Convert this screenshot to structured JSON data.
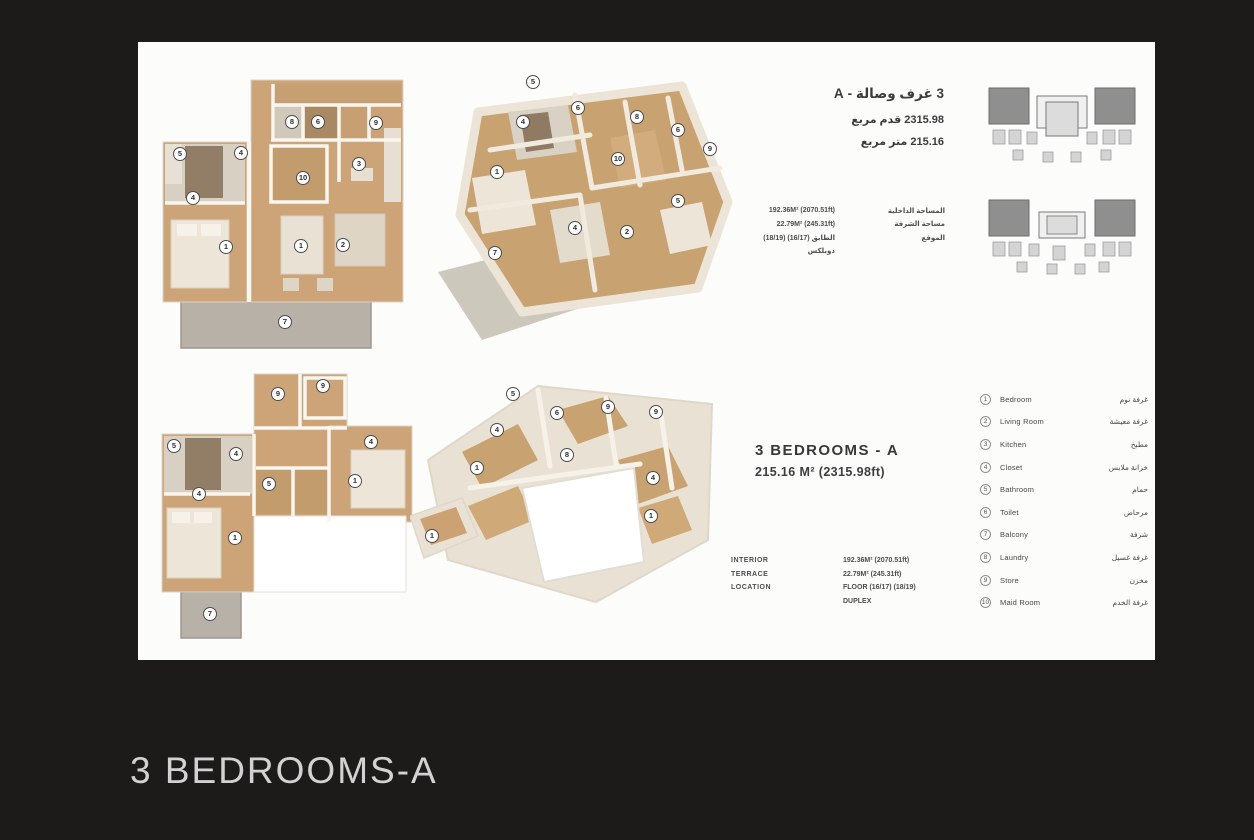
{
  "page": {
    "heading": "3 BEDROOMS-A"
  },
  "panel": {
    "arabic_title": {
      "line1": "3 غرف وصالة - A",
      "line2": "2315.98 قدم مربع",
      "line3": "215.16 متر مربع"
    },
    "unit_title": {
      "name": "3 BEDROOMS - A",
      "area": "215.16 M²  (2315.98ft)"
    },
    "info_top": {
      "rows": [
        {
          "value": "192.36M² (2070.51ft)",
          "label_ar": "المساحة الداخلية"
        },
        {
          "value": "22.79M² (245.31ft)",
          "label_ar": "مساحة الشرفة"
        },
        {
          "value": "الطابق (16/17) (18/19)",
          "label_ar": "الموقع"
        },
        {
          "value": "دوبلكس",
          "label_ar": ""
        }
      ]
    },
    "info_bottom": {
      "rows": [
        {
          "label": "INTERIOR",
          "value": "192.36M² (2070.51ft)"
        },
        {
          "label": "TERRACE",
          "value": "22.79M² (245.31ft)"
        },
        {
          "label": "LOCATION",
          "value": "FLOOR (16/17) (18/19)"
        },
        {
          "label": "",
          "value": "DUPLEX"
        }
      ]
    },
    "legend": {
      "items": [
        {
          "n": "1",
          "en": "Bedroom",
          "ar": "غرفة نوم"
        },
        {
          "n": "2",
          "en": "Living Room",
          "ar": "غرفة معيشة"
        },
        {
          "n": "3",
          "en": "Kitchen",
          "ar": "مطبخ"
        },
        {
          "n": "4",
          "en": "Closet",
          "ar": "خزانة ملابس"
        },
        {
          "n": "5",
          "en": "Bathroom",
          "ar": "حمام"
        },
        {
          "n": "6",
          "en": "Toilet",
          "ar": "مرحاض"
        },
        {
          "n": "7",
          "en": "Balcony",
          "ar": "شرفة"
        },
        {
          "n": "8",
          "en": "Laundry",
          "ar": "غرفة غسيل"
        },
        {
          "n": "9",
          "en": "Store",
          "ar": "مخزن"
        },
        {
          "n": "10",
          "en": "Maid Room",
          "ar": "غرفة الخدم"
        }
      ]
    },
    "plans": {
      "plan2d_top_markers": [
        {
          "n": "5",
          "x": 25,
          "y": 84
        },
        {
          "n": "4",
          "x": 86,
          "y": 83
        },
        {
          "n": "8",
          "x": 137,
          "y": 52
        },
        {
          "n": "6",
          "x": 163,
          "y": 52
        },
        {
          "n": "9",
          "x": 221,
          "y": 53
        },
        {
          "n": "10",
          "x": 148,
          "y": 108
        },
        {
          "n": "3",
          "x": 204,
          "y": 94
        },
        {
          "n": "4",
          "x": 38,
          "y": 128
        },
        {
          "n": "1",
          "x": 71,
          "y": 177
        },
        {
          "n": "1",
          "x": 146,
          "y": 176
        },
        {
          "n": "2",
          "x": 188,
          "y": 175
        },
        {
          "n": "7",
          "x": 130,
          "y": 252
        }
      ],
      "plan3d_top_markers": [
        {
          "n": "5",
          "x": 103,
          "y": 22
        },
        {
          "n": "4",
          "x": 93,
          "y": 62
        },
        {
          "n": "6",
          "x": 148,
          "y": 48
        },
        {
          "n": "8",
          "x": 207,
          "y": 57
        },
        {
          "n": "6",
          "x": 248,
          "y": 70
        },
        {
          "n": "9",
          "x": 280,
          "y": 89
        },
        {
          "n": "10",
          "x": 188,
          "y": 99
        },
        {
          "n": "1",
          "x": 67,
          "y": 112
        },
        {
          "n": "5",
          "x": 248,
          "y": 141
        },
        {
          "n": "4",
          "x": 145,
          "y": 168
        },
        {
          "n": "2",
          "x": 197,
          "y": 172
        },
        {
          "n": "7",
          "x": 65,
          "y": 193
        }
      ],
      "plan2d_bottom_markers": [
        {
          "n": "9",
          "x": 123,
          "y": 24
        },
        {
          "n": "9",
          "x": 168,
          "y": 16
        },
        {
          "n": "5",
          "x": 19,
          "y": 76
        },
        {
          "n": "4",
          "x": 81,
          "y": 84
        },
        {
          "n": "4",
          "x": 216,
          "y": 72
        },
        {
          "n": "1",
          "x": 200,
          "y": 111
        },
        {
          "n": "5",
          "x": 114,
          "y": 114
        },
        {
          "n": "4",
          "x": 44,
          "y": 124
        },
        {
          "n": "1",
          "x": 80,
          "y": 168
        },
        {
          "n": "7",
          "x": 55,
          "y": 244
        }
      ],
      "plan3d_bottom_markers": [
        {
          "n": "5",
          "x": 103,
          "y": 26
        },
        {
          "n": "4",
          "x": 87,
          "y": 62
        },
        {
          "n": "6",
          "x": 147,
          "y": 45
        },
        {
          "n": "9",
          "x": 198,
          "y": 39
        },
        {
          "n": "9",
          "x": 246,
          "y": 44
        },
        {
          "n": "1",
          "x": 67,
          "y": 100
        },
        {
          "n": "8",
          "x": 157,
          "y": 87
        },
        {
          "n": "4",
          "x": 243,
          "y": 110
        },
        {
          "n": "1",
          "x": 241,
          "y": 148
        },
        {
          "n": "1",
          "x": 22,
          "y": 168
        }
      ]
    },
    "colors": {
      "background": "#1d1b19",
      "floor_tan": "#cda477",
      "wall_cream": "#ece5d7",
      "terrace_gray": "#b7b1a7",
      "heading_text": "#d2d2d2"
    }
  }
}
